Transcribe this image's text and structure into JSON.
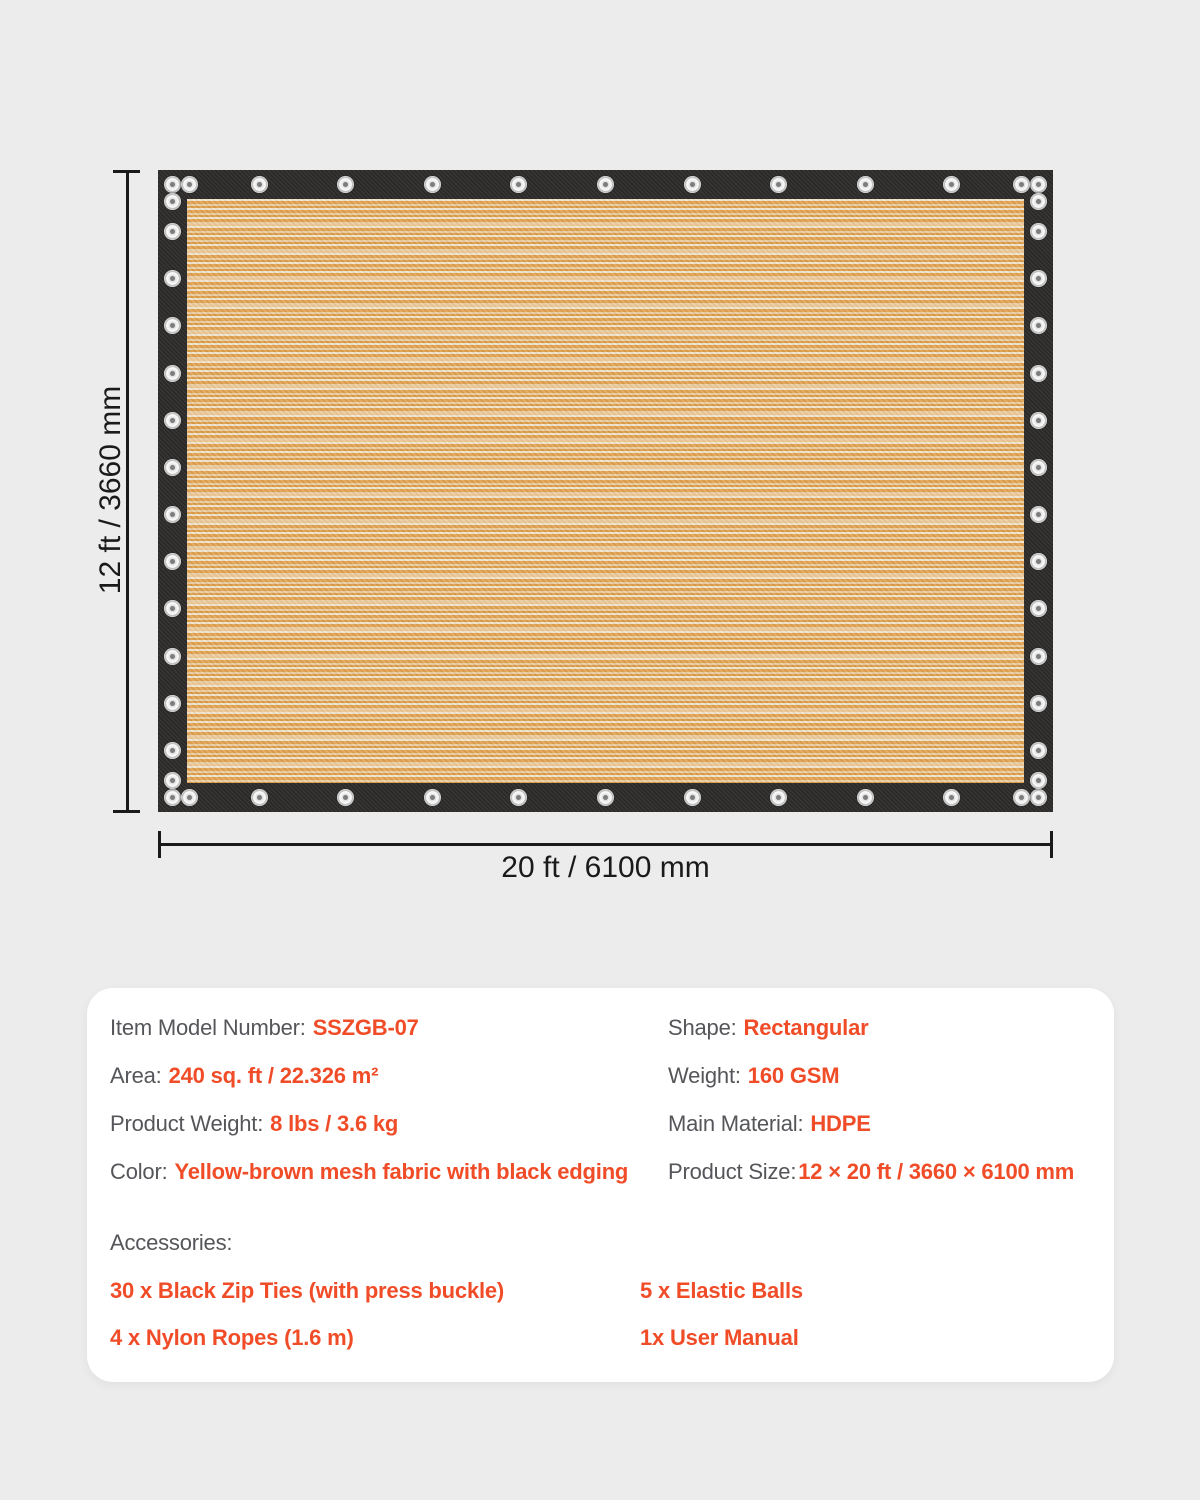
{
  "colors": {
    "accent": "#f04c28",
    "label": "#55565a",
    "background": "#ececec",
    "card": "#ffffff",
    "dimension": "#1a1a1a",
    "tarp_border": "#2c2b29",
    "fabric_orange": "#e0a14e",
    "fabric_cream": "#efe4cd"
  },
  "dimensions": {
    "height_label": "12 ft / 3660 mm",
    "width_label": "20 ft / 6100 mm"
  },
  "tarp": {
    "description": "yellow-brown striped mesh fabric with black edging and metal grommets",
    "grommets": {
      "top": 11,
      "bottom": 11,
      "left": 14,
      "right": 14,
      "corner_doubles": true,
      "color": "#ededed"
    }
  },
  "specs": {
    "left": [
      {
        "label": "Item Model Number:",
        "value": "SSZGB-07"
      },
      {
        "label": "Area:",
        "value": "240 sq. ft / 22.326 m²"
      },
      {
        "label": "Product Weight:",
        "value": "8 lbs / 3.6 kg"
      },
      {
        "label": "Color:",
        "value": "Yellow-brown mesh fabric with black edging"
      }
    ],
    "right": [
      {
        "label": "Shape:",
        "value": "Rectangular"
      },
      {
        "label": "Weight:",
        "value": "160 GSM"
      },
      {
        "label": "Main Material:",
        "value": "HDPE"
      },
      {
        "label": "Product Size:",
        "value": "12 × 20 ft / 3660 × 6100 mm"
      }
    ]
  },
  "accessories": {
    "label": "Accessories:",
    "items_left": [
      "30 x Black Zip Ties (with press buckle)",
      "4 x Nylon Ropes (1.6 m)"
    ],
    "items_right": [
      "5 x Elastic Balls",
      "1x User Manual"
    ]
  }
}
